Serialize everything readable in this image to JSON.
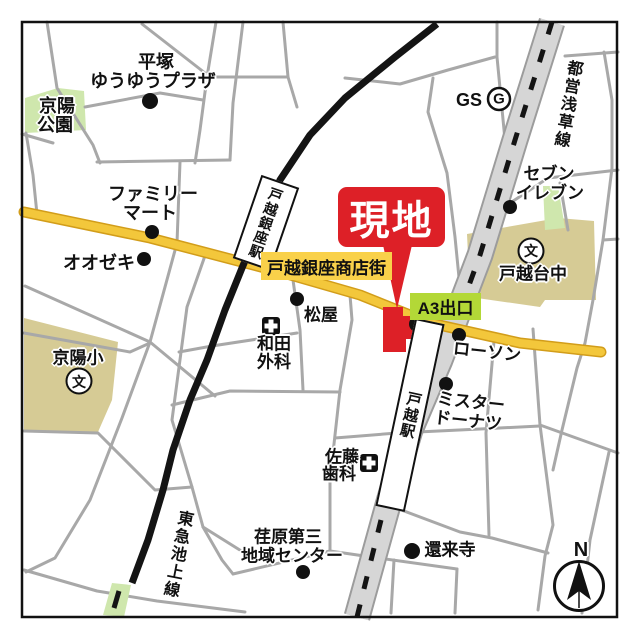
{
  "site_callout": "現地",
  "exit_label": "A3出口",
  "shopping_street": "戸越銀座商店街",
  "stations": {
    "togoshi_ginza": "戸越銀座駅",
    "togoshi": "戸越駅"
  },
  "rail_lines": {
    "toei_asakusa": "都営浅草線",
    "tokyu_ikegami": "東急池上線"
  },
  "pois": {
    "hiratsuka_plaza": [
      "平塚",
      "ゆうゆうプラザ"
    ],
    "keiyo_park": [
      "京陽",
      "公園"
    ],
    "family_mart": [
      "ファミリー",
      "マート"
    ],
    "oozeki": "オオゼキ",
    "keiyo_elementary": "京陽小",
    "school_mark": "文",
    "matsuya": "松屋",
    "wada_clinic": [
      "和田",
      "外科"
    ],
    "gs": "GS",
    "gs_mark": "G",
    "seven_eleven": [
      "セブン",
      "イレブン"
    ],
    "togoshidai_junior_high": "戸越台中",
    "lawson": "ローソン",
    "mister_donut": [
      "ミスター",
      "ドーナツ"
    ],
    "sato_dental": [
      "佐藤",
      "歯科"
    ],
    "ebara_center": [
      "荏原第三",
      "地域センター"
    ],
    "genraiji_temple": "還来寺"
  },
  "compass_north": "N",
  "colors": {
    "site_red": "#dd2027",
    "shopping_street_yellow": "#f3c73b",
    "shopping_street_edge": "#d29d1a",
    "label_yellow_bg": "#f9d14a",
    "exit_green_bg": "#b3d837",
    "park_green": "#cfe7ad",
    "school_tan": "#d6cb95",
    "road_gray": "#a8a8a8",
    "subway_road_fill": "#d6d6d6",
    "railway_black": "#141414"
  }
}
